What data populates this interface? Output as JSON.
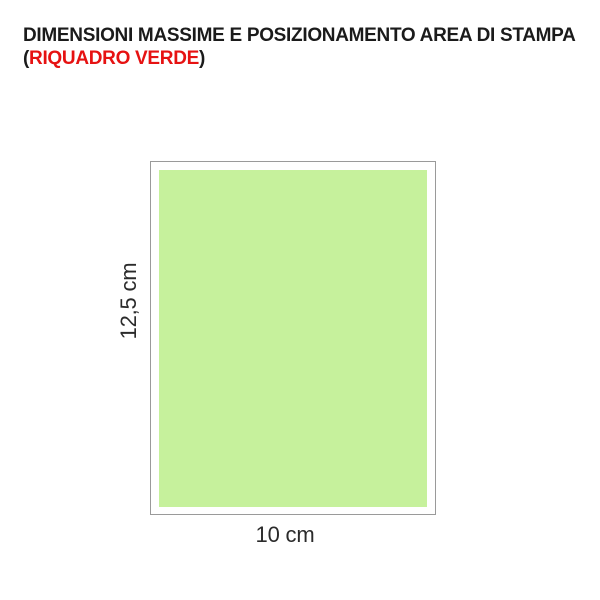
{
  "page": {
    "background_color": "#ffffff"
  },
  "title": {
    "line1": "DIMENSIONI MASSIME E POSIZIONAMENTO AREA DI STAMPA",
    "line2_paren_open": "(",
    "line2_highlight": "RIQUADRO VERDE",
    "line2_paren_close": ")",
    "text_color": "#1b1b1b",
    "highlight_color": "#e61212"
  },
  "diagram": {
    "outer_box": {
      "border_color": "#9a9a9a",
      "fill_color": "#ffffff"
    },
    "print_area": {
      "fill_color": "#c6f19c"
    },
    "height_label": "12,5 cm",
    "width_label": "10 cm",
    "label_color": "#2b2b2b"
  }
}
